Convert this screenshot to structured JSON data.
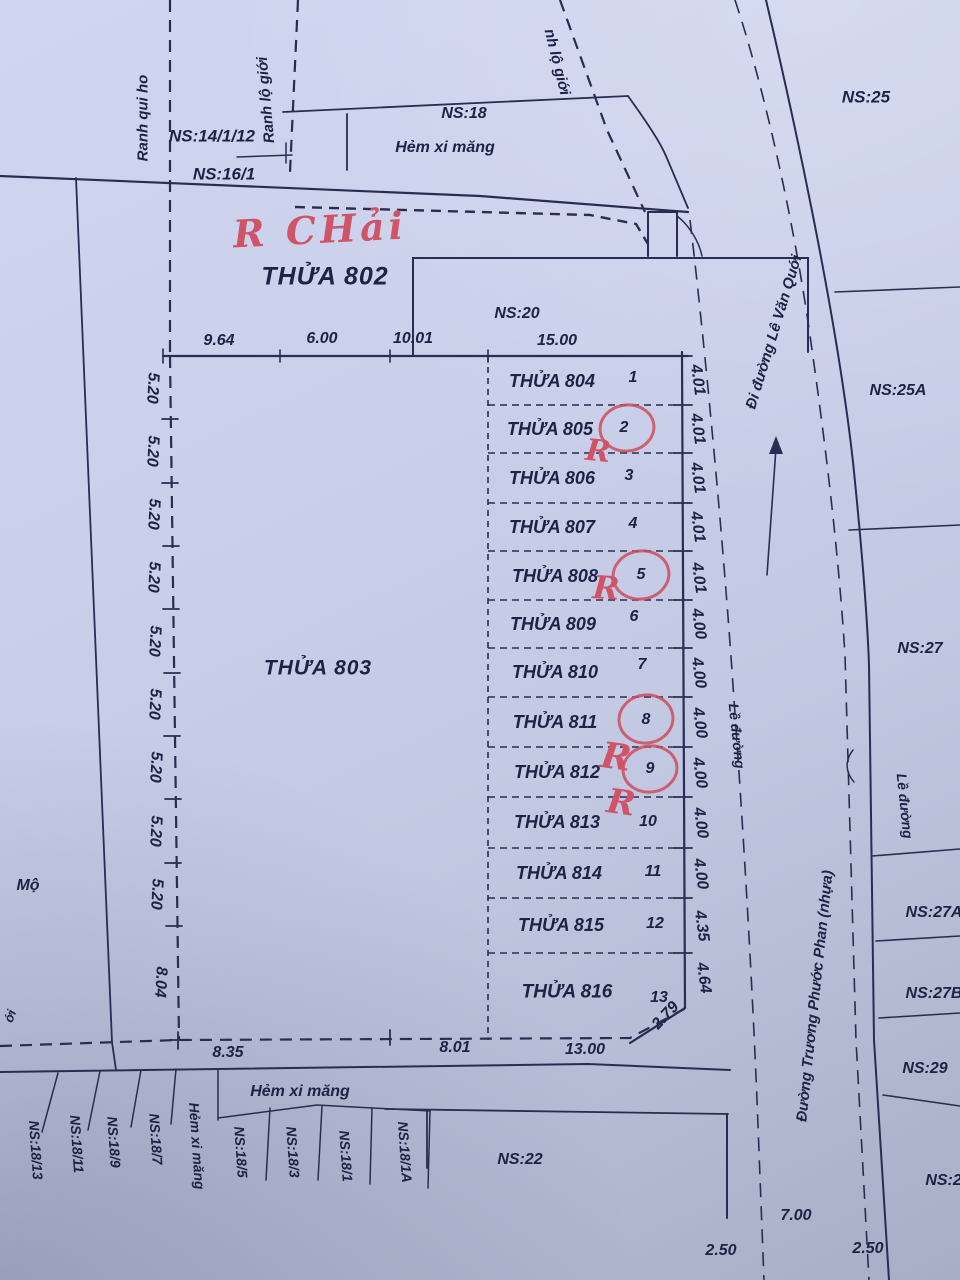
{
  "palette": {
    "paper": "#c8cee8",
    "ink": "#272e52",
    "text": "#1c2344",
    "red": "#cc5064"
  },
  "top": {
    "ranh_qui_hoach": "Ranh qui ho",
    "ranh_lo_gioi_left": "Ranh lộ giới",
    "ranh_lo_gioi_mid": "nh lộ giới",
    "ns_14_1_12": "NS:14/1/12",
    "ns_16_1": "NS:16/1",
    "ns_18": "NS:18",
    "hem_xi_mang": "Hẻm xi măng",
    "ns_25": "NS:25"
  },
  "annotations": {
    "r_chai": "R CHải",
    "r_mark": "R"
  },
  "blocks": {
    "thua_802": "THỬA 802",
    "thua_803": "THỬA 803",
    "ns_20": "NS:20",
    "mo": "Mộ",
    "edge_fragment": "ới"
  },
  "top_dims": {
    "d1": "9.64",
    "d2": "6.00",
    "d3": "10.01",
    "d4": "15.00"
  },
  "left_dims": [
    "5.20",
    "5.20",
    "5.20",
    "5.20",
    "5.20",
    "5.20",
    "5.20",
    "5.20",
    "5.20",
    "8.04"
  ],
  "plots": [
    {
      "name": "THỬA 804",
      "num": "1",
      "dim": "4.01"
    },
    {
      "name": "THỬA 805",
      "num": "2",
      "dim": "4.01"
    },
    {
      "name": "THỬA 806",
      "num": "3",
      "dim": "4.01"
    },
    {
      "name": "THỬA 807",
      "num": "4",
      "dim": "4.01"
    },
    {
      "name": "THỬA 808",
      "num": "5",
      "dim": "4.01"
    },
    {
      "name": "THỬA 809",
      "num": "6",
      "dim": "4.00"
    },
    {
      "name": "THỬA 810",
      "num": "7",
      "dim": "4.00"
    },
    {
      "name": "THỬA 811",
      "num": "8",
      "dim": "4.00"
    },
    {
      "name": "THỬA 812",
      "num": "9",
      "dim": "4.00"
    },
    {
      "name": "THỬA 813",
      "num": "10",
      "dim": "4.00"
    },
    {
      "name": "THỬA 814",
      "num": "11",
      "dim": "4.00"
    },
    {
      "name": "THỬA 815",
      "num": "12",
      "dim": "4.35"
    },
    {
      "name": "THỬA 816",
      "num": "13",
      "dim": "4.64"
    }
  ],
  "chamfer": "2.79",
  "bottom_dims": {
    "d1": "8.35",
    "d2": "8.01",
    "d3": "13.00"
  },
  "bottom": {
    "hem_xi_mang": "Hẻm xi măng",
    "hem_xi_mang_vertical": "Hẻm xi măng",
    "ns_22": "NS:22",
    "d_250a": "2.50",
    "d_700": "7.00",
    "d_250b": "2.50",
    "parcels": [
      "NS:18/13",
      "NS:18/11",
      "NS:18/9",
      "NS:18/7",
      "NS:18/5",
      "NS:18/3",
      "NS:18/1",
      "NS:18/1A"
    ]
  },
  "roads": {
    "di_duong": "Đi đường Lê Văn Quới",
    "le_duong_left": "Lề đường",
    "le_duong_right": "Lề đường",
    "duong_truong": "Đường Trương Phước Phan (nhựa)"
  },
  "right_parcels": {
    "ns_25a": "NS:25A",
    "ns_27": "NS:27",
    "ns_27a": "NS:27A",
    "ns_27b": "NS:27B",
    "ns_29": "NS:29",
    "ns_28": "NS:28"
  }
}
